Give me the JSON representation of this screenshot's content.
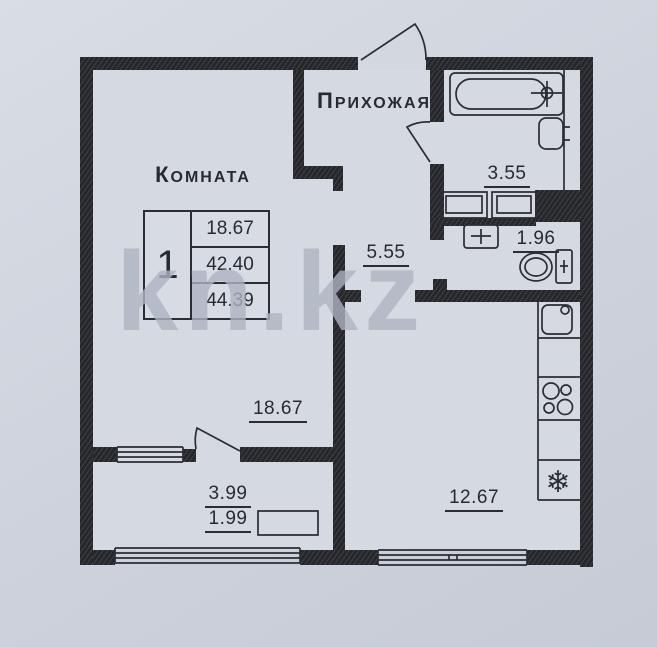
{
  "watermark": "kn.kz",
  "plan": {
    "room": {
      "title": "Комната",
      "area": "18.67"
    },
    "hallway": {
      "title": "Прихожая",
      "area": "5.55"
    },
    "bathroom": {
      "area": "3.55"
    },
    "toilet": {
      "area": "1.96"
    },
    "kitchen": {
      "area": "12.67"
    },
    "balcony": {
      "area_full": "3.99",
      "area_half": "1.99"
    }
  },
  "info_table": {
    "room_count": "1",
    "rows": [
      "18.67",
      "42.40",
      "44.39"
    ]
  },
  "icons": {
    "fridge_symbol": "❄"
  },
  "colors": {
    "wall": "#26272b",
    "paper": "#d5d9e2",
    "ink": "#2b2d33",
    "watermark": "#aeb4c2"
  }
}
